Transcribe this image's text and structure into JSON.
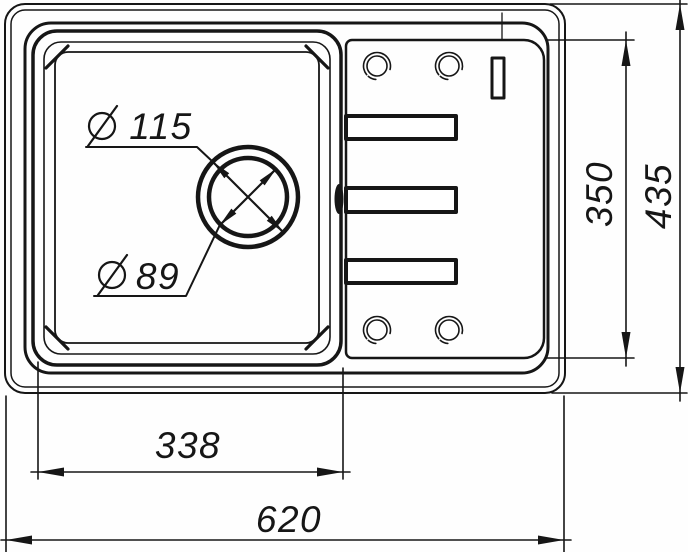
{
  "title": "Sink technical drawing — top view",
  "colors": {
    "line": "#161616",
    "background": "#ffffff"
  },
  "dimensions": {
    "overall_width": {
      "label": "620",
      "orientation": "horizontal"
    },
    "overall_height": {
      "label": "435",
      "orientation": "vertical"
    },
    "drainboard_height": {
      "label": "350",
      "orientation": "vertical"
    },
    "bowl_width": {
      "label": "338",
      "orientation": "horizontal"
    },
    "drain_outer_diameter": {
      "symbol": "∅",
      "label": "115"
    },
    "drain_inner_diameter": {
      "symbol": "∅",
      "label": "89"
    }
  },
  "features": {
    "tap_holes": 4,
    "drainer_ribs": 3,
    "slot": 1,
    "overflow": 1
  }
}
